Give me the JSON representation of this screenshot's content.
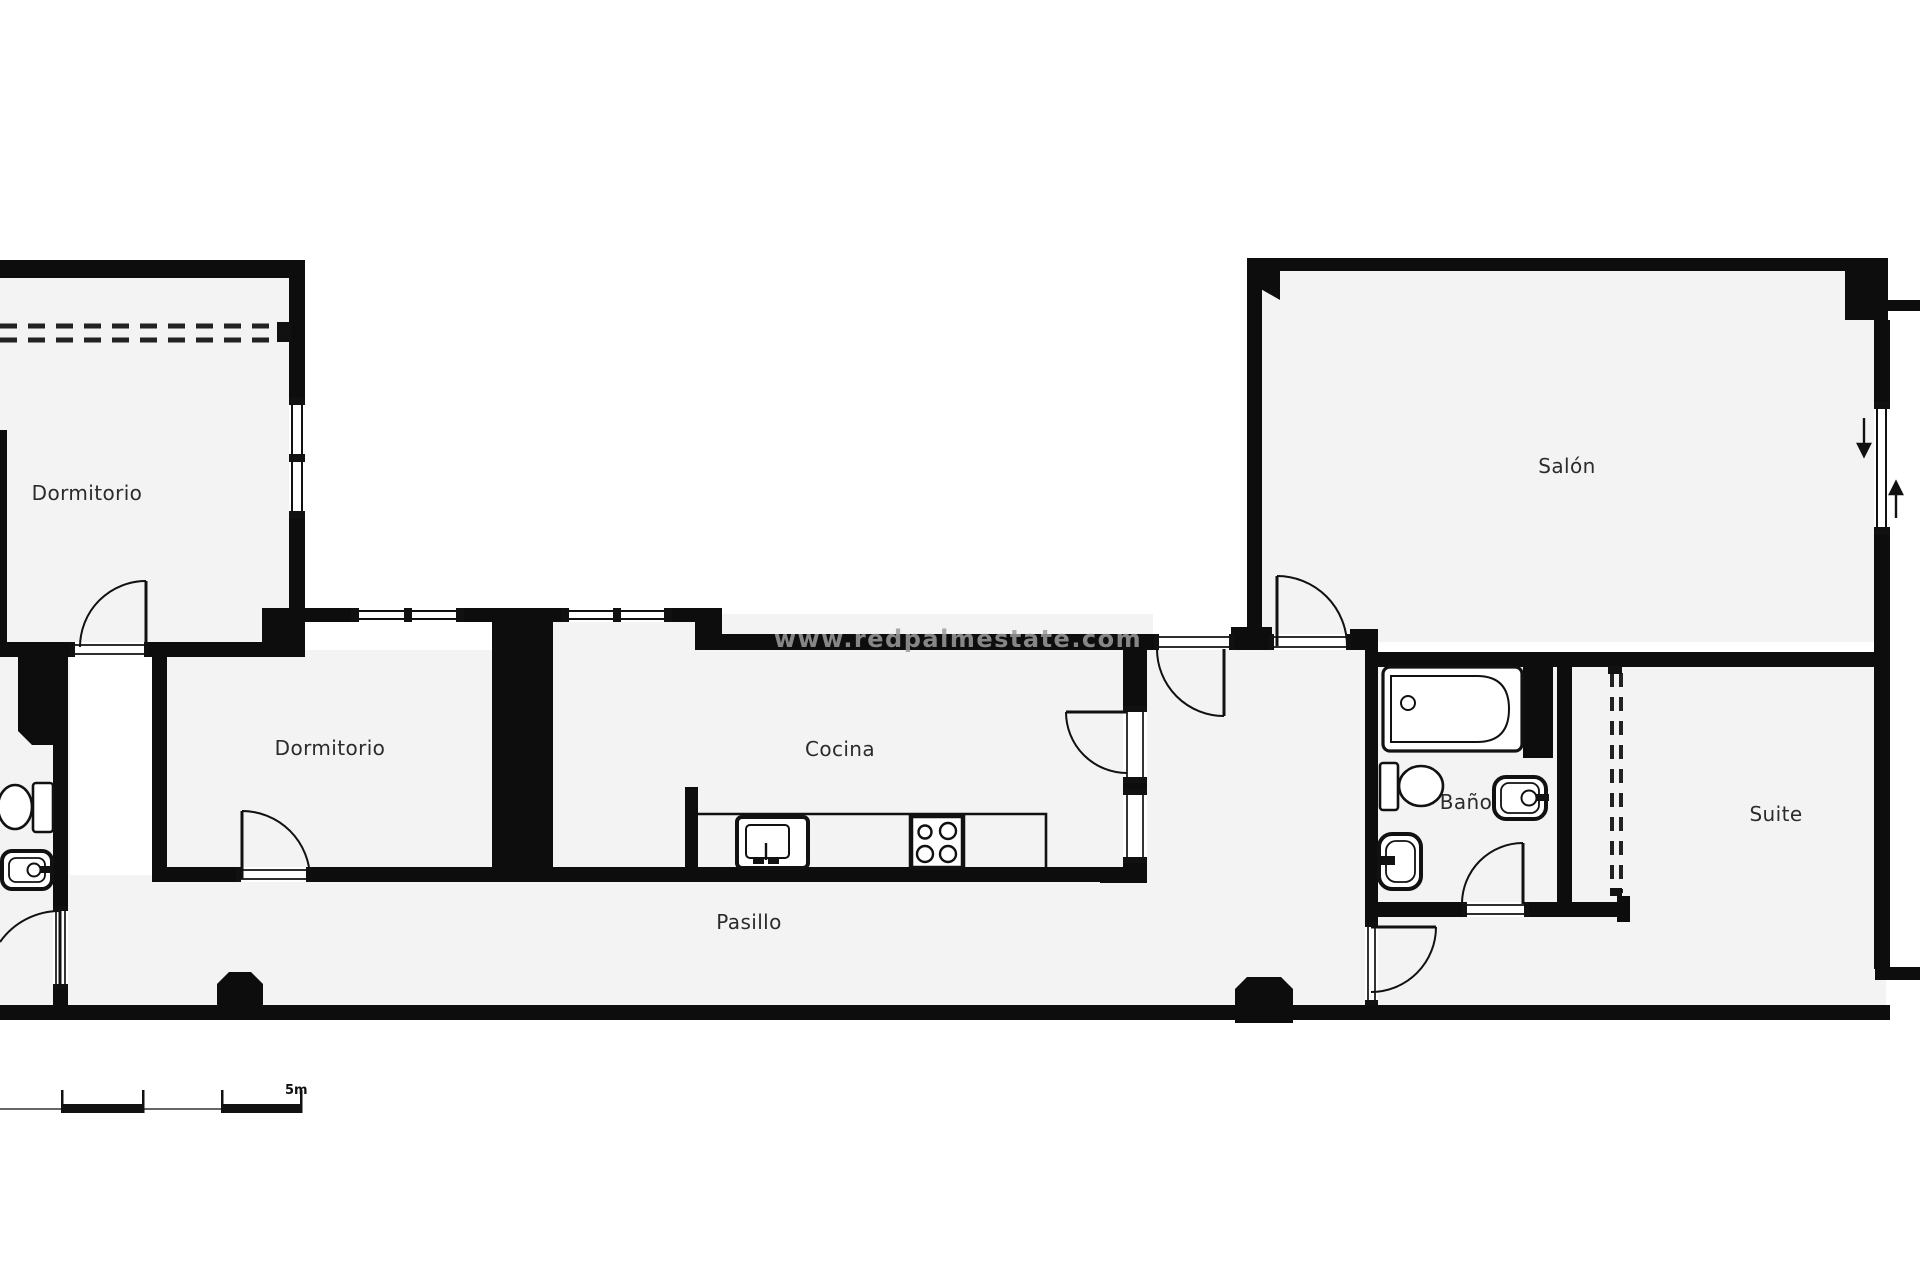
{
  "title": "Apartment floor plan",
  "colors": {
    "wall": "#0d0d0d",
    "floor": "#f3f3f3",
    "background": "#ffffff",
    "label": "#2b2b2b",
    "watermark": "#9c9c9c"
  },
  "rooms": [
    {
      "id": "dormitorio-1",
      "label": "Dormitorio"
    },
    {
      "id": "dormitorio-2",
      "label": "Dormitorio"
    },
    {
      "id": "cocina",
      "label": "Cocina"
    },
    {
      "id": "pasillo",
      "label": "Pasillo"
    },
    {
      "id": "salon",
      "label": "Salón"
    },
    {
      "id": "bano",
      "label": "Baño"
    },
    {
      "id": "suite",
      "label": "Suite"
    }
  ],
  "watermark": {
    "text": "www.redpalmestate.com"
  },
  "scale_bar": {
    "label": "5m"
  },
  "icons": [
    {
      "name": "bathtub-icon"
    },
    {
      "name": "toilet-icon"
    },
    {
      "name": "washbasin-icon"
    },
    {
      "name": "bidet-icon"
    },
    {
      "name": "kitchen-sink-icon"
    },
    {
      "name": "stove-icon"
    },
    {
      "name": "door-arc-icon"
    },
    {
      "name": "window-icon"
    },
    {
      "name": "arrow-down-icon"
    },
    {
      "name": "arrow-up-icon"
    }
  ]
}
